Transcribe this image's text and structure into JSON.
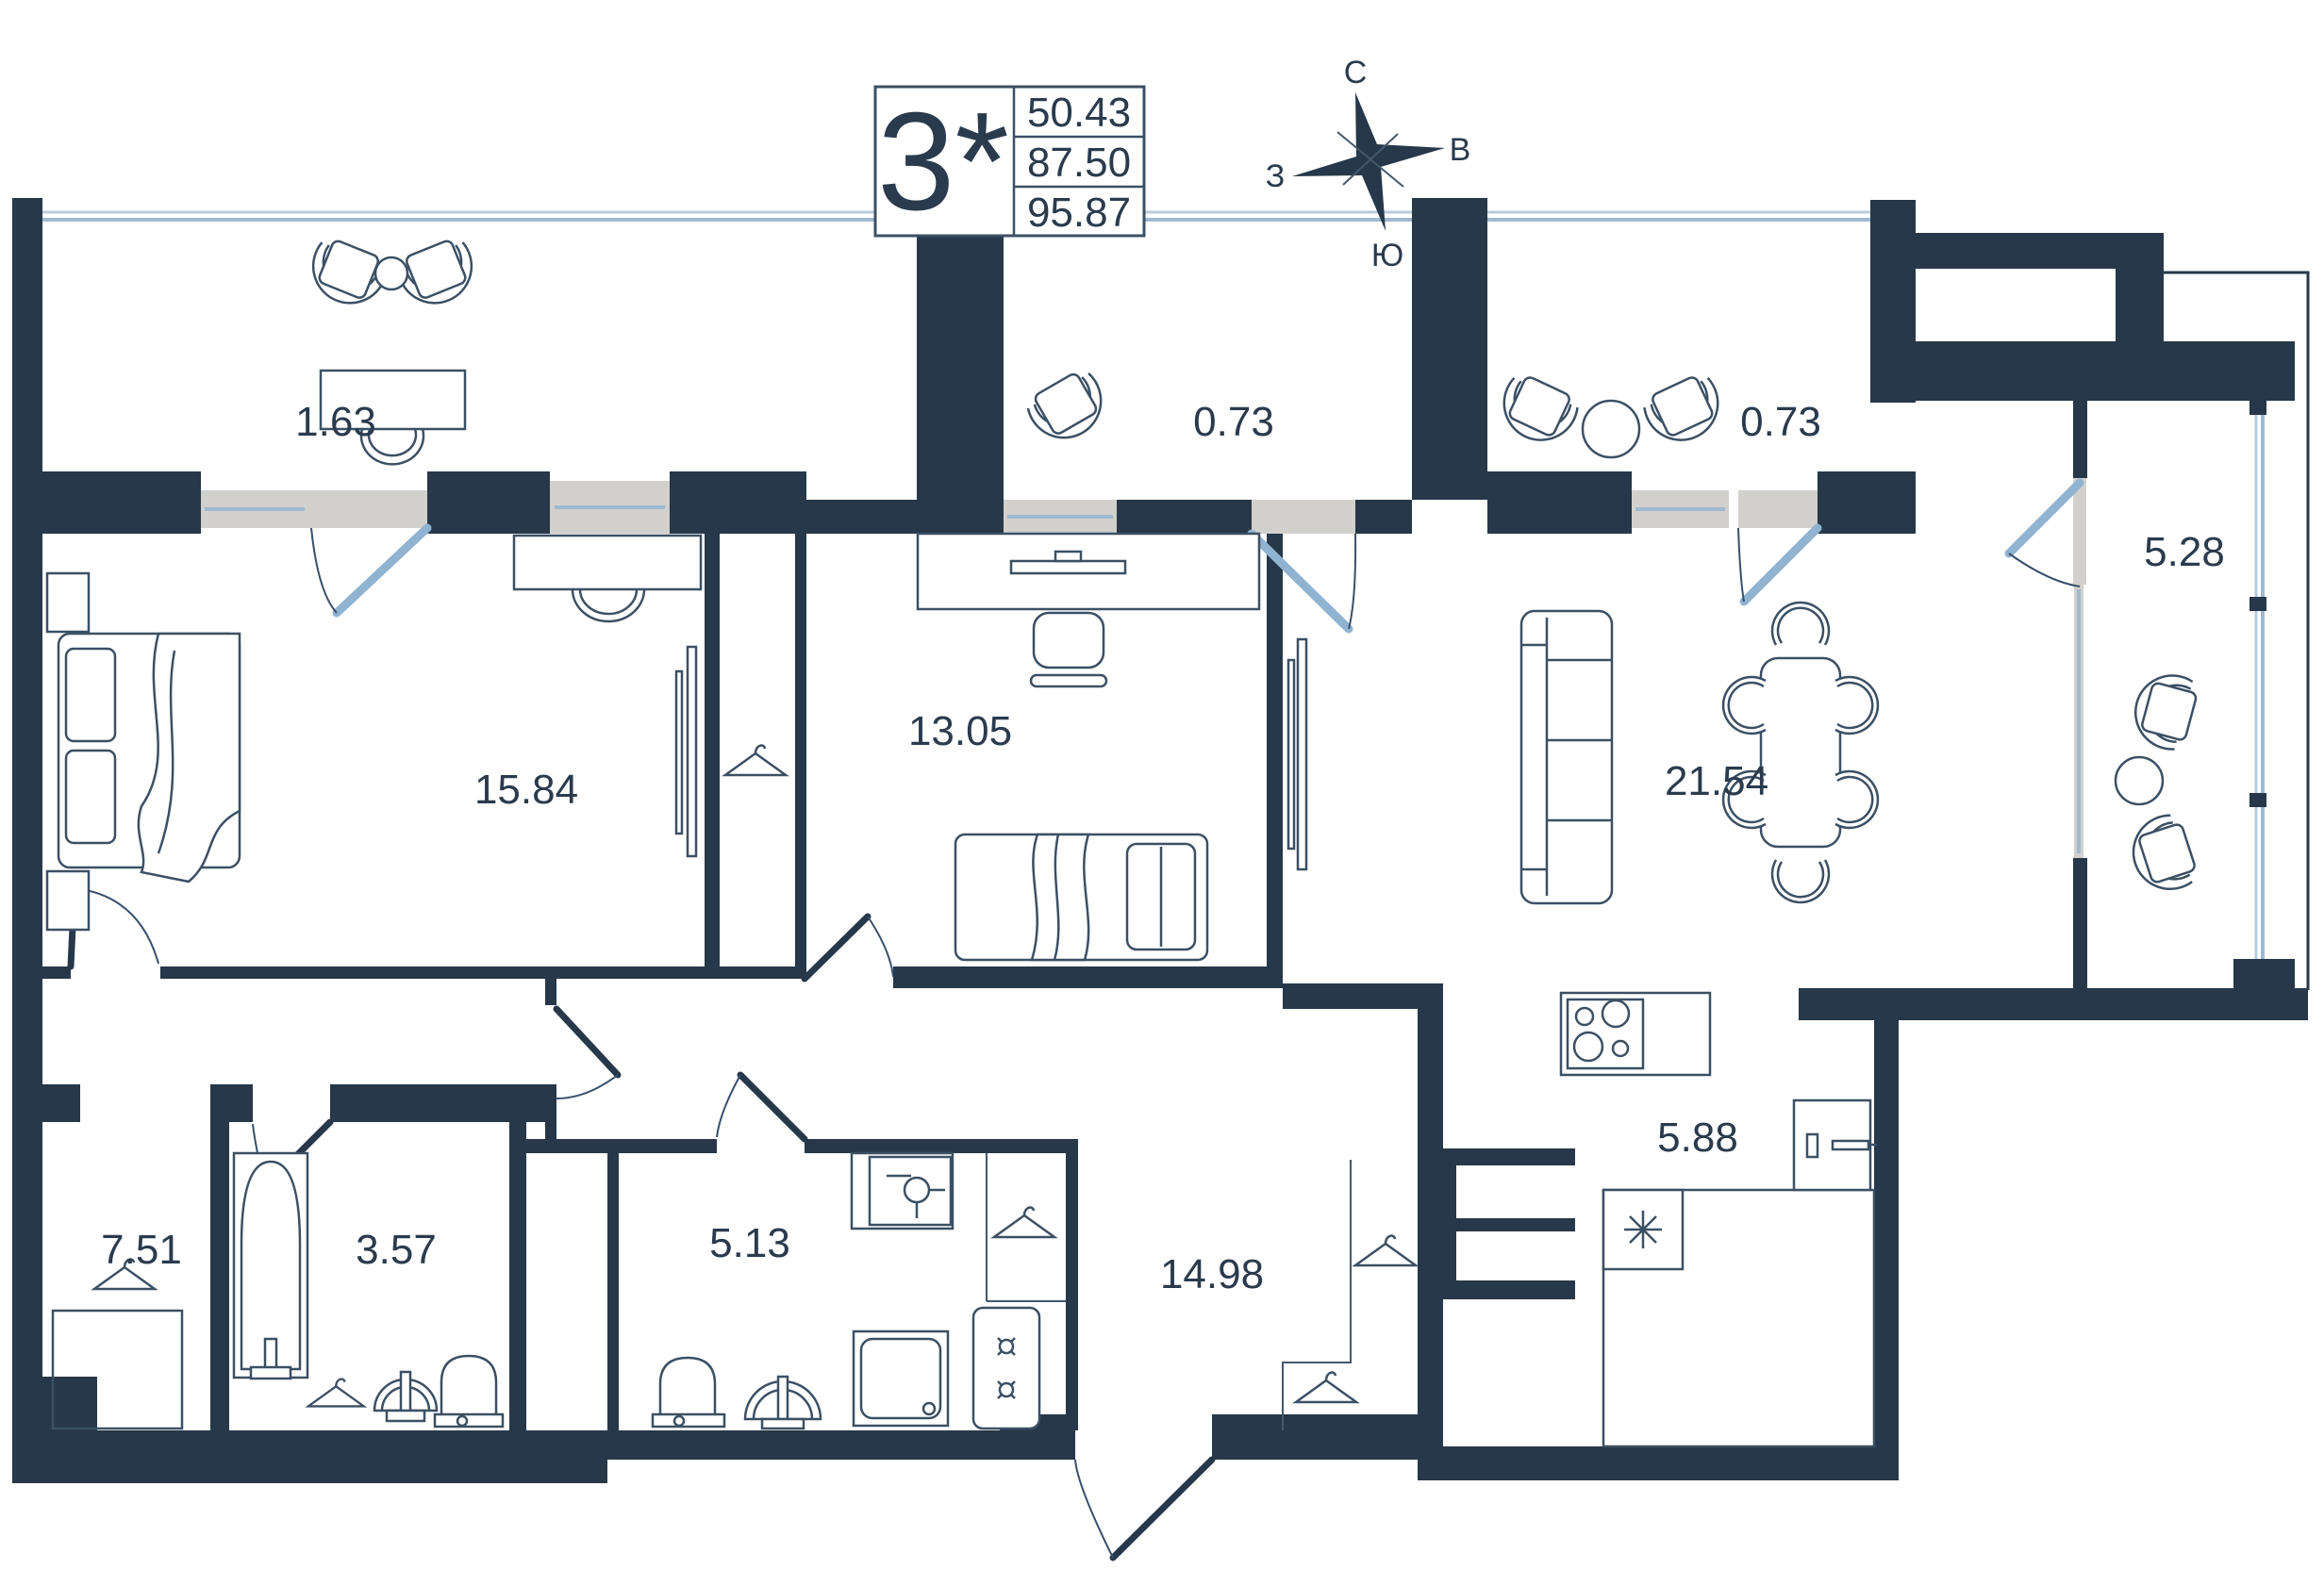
{
  "title_block": {
    "rooms_label": "3*",
    "areas": [
      "50.43",
      "87.50",
      "95.87"
    ]
  },
  "compass": {
    "north": "С",
    "east": "В",
    "south": "Ю",
    "west": "З"
  },
  "rooms": [
    {
      "name": "balcony-left",
      "area": "1.63"
    },
    {
      "name": "balcony-middle",
      "area": "0.73"
    },
    {
      "name": "balcony-right",
      "area": "0.73"
    },
    {
      "name": "loggia",
      "area": "5.28"
    },
    {
      "name": "bedroom",
      "area": "15.84"
    },
    {
      "name": "office",
      "area": "13.05"
    },
    {
      "name": "living-room",
      "area": "21.54"
    },
    {
      "name": "wardrobe",
      "area": "7.51"
    },
    {
      "name": "bathroom",
      "area": "3.57"
    },
    {
      "name": "shower-room",
      "area": "5.13"
    },
    {
      "name": "hallway",
      "area": "14.98"
    },
    {
      "name": "kitchen",
      "area": "5.88"
    }
  ],
  "colors": {
    "wall": "#263849",
    "furniture_stroke": "#3b5064",
    "door_leaf": "#8fb3d1",
    "glazing": "#b7cbdc",
    "door_gap": "#d2d0cc",
    "label_text": "#2a3b4d"
  }
}
